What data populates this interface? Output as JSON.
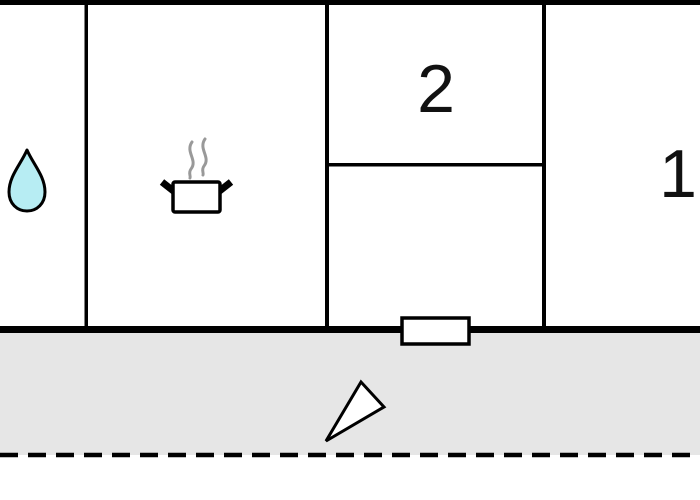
{
  "floorplan": {
    "type": "apartment-floor-plan",
    "rooms": {
      "bathroom": {
        "icon": "water-drop-icon",
        "label": ""
      },
      "kitchen": {
        "icon": "cooking-pot-icon",
        "label": ""
      },
      "room2": {
        "label": "2"
      },
      "room1": {
        "label": "1"
      }
    },
    "features": {
      "entrance_door": "door-marker",
      "entrance_direction": "entrance-arrow-icon",
      "terrace": "terrace-area",
      "boundary": "dashed-property-line"
    },
    "colors": {
      "wall": "#000000",
      "terrace_fill": "#e6e6e6",
      "water_drop_fill": "#b7edf3",
      "steam_stroke": "#999999",
      "door_fill": "#ffffff",
      "background": "#ffffff"
    }
  }
}
